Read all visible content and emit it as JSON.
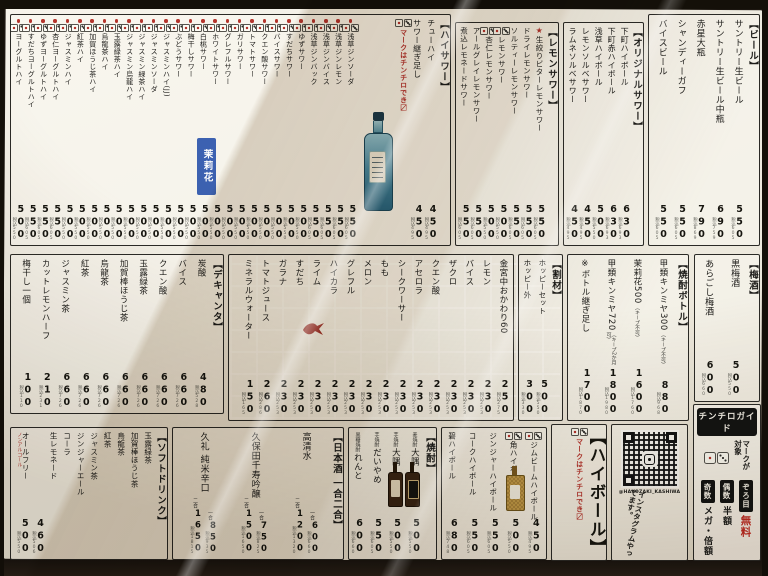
{
  "notes": {
    "chinchiro_hint": "マークはチンチロでき〼"
  },
  "sections": {
    "beer": {
      "title": "【ビール】",
      "items": [
        {
          "name": "サントリー生ビール",
          "price": "550",
          "tax": "税込605"
        },
        {
          "name": "サントリー生ビール中瓶",
          "price": "690",
          "tax": "税込759"
        },
        {
          "name": "赤星大瓶",
          "price": "790",
          "tax": "税込869"
        },
        {
          "name": "シャンディーガフ",
          "price": "550",
          "tax": "税込605"
        },
        {
          "name": "バイスビール",
          "price": "550",
          "tax": "税込605"
        }
      ]
    },
    "original_sour": {
      "title": "【オリジナルサワー】",
      "items": [
        {
          "name": "下町ハイボール",
          "price": "630",
          "tax": "税込693"
        },
        {
          "name": "下町赤ハイボール",
          "price": "630",
          "tax": "税込693"
        },
        {
          "name": "浅草ハイボール",
          "price": "500",
          "tax": "税込550"
        },
        {
          "name": "レモンソルベサワー",
          "price": "450",
          "tax": "税込495"
        },
        {
          "name": "ラムネソルベサワー",
          "price": "450",
          "tax": "税込495"
        }
      ]
    },
    "lemon_sour": {
      "title": "【レモンサワー】",
      "items": [
        {
          "name": "生絞りビターレモンサワー",
          "star": true,
          "price": "550",
          "tax": "税込605"
        },
        {
          "name": "ドライレモンサワー",
          "price": "550",
          "tax": "税込605"
        },
        {
          "name": "ソルティーレモンサワー",
          "price": "550",
          "tax": "税込605"
        },
        {
          "name": "レモンサワー",
          "dice": true,
          "price": "500",
          "tax": "税込550"
        },
        {
          "name": "杏仁レモンサワー",
          "dice": true,
          "price": "500",
          "tax": "税込550"
        },
        {
          "name": "アールグレイレモンサワー",
          "price": "550",
          "tax": "税込605"
        },
        {
          "name": "煮込レモネードサワー",
          "price": "550",
          "tax": "税込605"
        }
      ]
    },
    "haisawa": {
      "title": "【ハイサワー】",
      "lead_items": [
        {
          "name": "チューハイ",
          "price": "450",
          "tax": "税込495"
        },
        {
          "name": "サワー継ぎ足し",
          "price": "450",
          "tax": "税込495"
        }
      ],
      "note": "マークはチンチロでき〼",
      "items": [
        {
          "name": "浅草ジンソーダ",
          "dice": "red",
          "price": "550",
          "tax": "税込605"
        },
        {
          "name": "浅草ジンレモン",
          "dice": "red",
          "price": "550",
          "tax": "税込605"
        },
        {
          "name": "浅草ジンバイス",
          "dice": "red",
          "price": "550",
          "tax": "税込605"
        },
        {
          "name": "浅草ジンバック",
          "dice": "red",
          "price": "550",
          "tax": "税込605"
        },
        {
          "name": "ゆずサワー",
          "dice": "red",
          "price": "500",
          "tax": "税込550"
        },
        {
          "name": "すだちサワー",
          "dice": "red",
          "price": "500",
          "tax": "税込550"
        },
        {
          "name": "バイスサワー",
          "dice": "red",
          "price": "500",
          "tax": "税込550"
        },
        {
          "name": "クエン酸サワー",
          "dice": "red",
          "price": "500",
          "tax": "税込550"
        },
        {
          "name": "トマトサワー",
          "dice": "red",
          "price": "500",
          "tax": "税込550"
        },
        {
          "name": "ガリサワー",
          "dice": "red",
          "price": "500",
          "tax": "税込550"
        },
        {
          "name": "グレフルサワー",
          "dice": "red",
          "price": "500",
          "tax": "税込550"
        },
        {
          "name": "ホワイトサワー",
          "dice": "red",
          "price": "500",
          "tax": "税込550"
        },
        {
          "name": "白桃サワー",
          "dice": "red",
          "price": "500",
          "tax": "税込550"
        },
        {
          "name": "梅干しサワー",
          "dice": "red",
          "price": "500",
          "tax": "税込550"
        },
        {
          "name": "ぶどうサワー",
          "dice": "red",
          "price": "500",
          "tax": "税込550"
        },
        {
          "name": "ジャスミンハイ(JJ)",
          "dice": "red",
          "price": "500",
          "tax": "税込550"
        },
        {
          "name": "ジャスミンソーダ",
          "dice": "red",
          "price": "500",
          "tax": "税込550"
        },
        {
          "name": "ジャスミン緑茶ハイ",
          "dice": "red",
          "price": "500",
          "tax": "税込550"
        },
        {
          "name": "ジャスミン烏龍ハイ",
          "dice": "red",
          "price": "500",
          "tax": "税込550"
        },
        {
          "name": "玉露緑茶ハイ",
          "dice": "red",
          "price": "500",
          "tax": "税込550"
        },
        {
          "name": "烏龍茶ハイ",
          "dice": "red",
          "price": "500",
          "tax": "税込550"
        },
        {
          "name": "加賀ほうじ茶ハイ",
          "dice": "red",
          "price": "500",
          "tax": "税込550"
        },
        {
          "name": "紅茶ハイ",
          "dice": "red",
          "price": "500",
          "tax": "税込550"
        },
        {
          "name": "ジャスミンハイ",
          "dice": "red",
          "price": "500",
          "tax": "税込550"
        },
        {
          "name": "杏仁ヨーグルトハイ",
          "dice": "red",
          "price": "550",
          "tax": "税込605"
        },
        {
          "name": "ゆずヨーグルトハイ",
          "dice": "red",
          "price": "550",
          "tax": "税込605"
        },
        {
          "name": "すだちヨーグルトハイ",
          "dice": "red",
          "price": "550",
          "tax": "税込605"
        },
        {
          "name": "ヨーグルトハイ",
          "dice": "red",
          "price": "500",
          "tax": "税込550"
        }
      ]
    },
    "decanter": {
      "title": "【デキャンタ】",
      "items": [
        {
          "name": "炭酸",
          "price": "480",
          "tax": "税込528"
        },
        {
          "name": "バイス",
          "price": "660",
          "tax": "税込726"
        },
        {
          "name": "クエン酸",
          "price": "660",
          "tax": "税込726"
        },
        {
          "name": "玉露緑茶",
          "price": "660",
          "tax": "税込726"
        },
        {
          "name": "加賀棒ほうじ茶",
          "price": "660",
          "tax": "税込726"
        },
        {
          "name": "烏龍茶",
          "price": "660",
          "tax": "税込726"
        },
        {
          "name": "紅茶",
          "price": "660",
          "tax": "税込726"
        },
        {
          "name": "ジャスミン茶",
          "price": "660",
          "tax": "税込726"
        },
        {
          "name": "カットレモンハーフ",
          "price": "210",
          "tax": "税込231"
        },
        {
          "name": "梅干し一個",
          "price": "100",
          "tax": "税込110"
        }
      ]
    },
    "mixers": {
      "items": [
        {
          "name": "金宮中おかわり60",
          "price": "250",
          "tax": "税込275"
        },
        {
          "name": "レモン",
          "price": "230",
          "tax": "税込253"
        },
        {
          "name": "バイス",
          "price": "230",
          "tax": "税込253"
        },
        {
          "name": "ザクロ",
          "price": "230",
          "tax": "税込253"
        },
        {
          "name": "クエン酸",
          "price": "230",
          "tax": "税込253"
        },
        {
          "name": "アセロラ",
          "price": "230",
          "tax": "税込253"
        },
        {
          "name": "シークワーサー",
          "price": "230",
          "tax": "税込253"
        },
        {
          "name": "もも",
          "price": "230",
          "tax": "税込253"
        },
        {
          "name": "メロン",
          "price": "230",
          "tax": "税込253"
        },
        {
          "name": "グレフル",
          "price": "230",
          "tax": "税込253"
        },
        {
          "name": "ハイカラ",
          "price": "230",
          "tax": "税込253"
        },
        {
          "name": "ライム",
          "price": "230",
          "tax": "税込253"
        },
        {
          "name": "すだち",
          "price": "230",
          "tax": "税込253"
        },
        {
          "name": "ガラナ",
          "price": "230",
          "tax": "税込253"
        },
        {
          "name": "トマトジュース",
          "price": "260",
          "tax": "税込286"
        },
        {
          "name": "ミネラルウォーター",
          "price": "150",
          "tax": "税込165"
        }
      ]
    },
    "warizai": {
      "title": "【割材】",
      "items": [
        {
          "name": "ホッピーセット",
          "price": "500",
          "tax": "税込550"
        },
        {
          "name": "ホッピー外",
          "price": "300",
          "tax": "税込330"
        }
      ]
    },
    "shochu_bottle": {
      "title": "【焼酎ボトル】",
      "items": [
        {
          "name": "甲類キンミヤ300",
          "note": "（キープ不可）",
          "price": "880",
          "tax": "税込968"
        },
        {
          "name": "茉莉花500",
          "note": "（キープ不可）",
          "price": "1600",
          "tax": "税込1760"
        },
        {
          "name": "甲類キンミヤ720",
          "note": "（キープ2か月可）",
          "price": "1800",
          "tax": "税込1980"
        },
        {
          "name": "※ボトル継ぎ足し",
          "price": "1700",
          "tax": "税込1870"
        }
      ]
    },
    "umeshu": {
      "title": "【梅酒】",
      "items": [
        {
          "name": "黒梅酒",
          "price": "500",
          "tax": "税込550"
        },
        {
          "name": "あらごし梅酒",
          "price": "600",
          "tax": "税込660"
        }
      ]
    },
    "softdrink": {
      "title": "【ソフトドリンク】",
      "group_items": [
        "玉露緑茶",
        "加賀棒ほうじ茶",
        "烏龍茶",
        "紅茶",
        "ジャスミン茶",
        "ジンジャーエール",
        "コーラ",
        "生レモネード"
      ],
      "group_price": {
        "price": "460",
        "tax": "税込506"
      },
      "extra": {
        "name": "オールフリー",
        "red_note": "ノンアルコール",
        "price": "500",
        "tax": "税込550"
      }
    },
    "sake": {
      "title": "【日本酒 一合二合】",
      "items": [
        {
          "name": "高清水",
          "prices": [
            {
              "label": "一合",
              "price": "600",
              "tax": "税込660"
            },
            {
              "label": "二合",
              "price": "1200",
              "tax": "税込1320"
            }
          ]
        },
        {
          "name": "久保田千寿吟醸",
          "prices": [
            {
              "label": "一合",
              "price": "750",
              "tax": "税込825"
            },
            {
              "label": "二合",
              "price": "1500",
              "tax": "税込1650"
            }
          ]
        },
        {
          "name": "久礼 純米辛口",
          "prices": [
            {
              "label": "一合",
              "price": "850",
              "tax": "税込935"
            },
            {
              "label": "二合",
              "price": "1650",
              "tax": "税込1815"
            }
          ]
        }
      ]
    },
    "shochu": {
      "title": "【焼酎】",
      "items": [
        {
          "prefix": "麦焼酎",
          "name": "大隅",
          "price": "500",
          "tax": "税込550"
        },
        {
          "prefix": "芋焼酎",
          "name": "大隅",
          "price": "500",
          "tax": "税込550"
        },
        {
          "prefix": "芋焼酎",
          "name": "だいやめ",
          "price": "550",
          "tax": "税込605"
        },
        {
          "prefix": "黒糖焼酎",
          "name": "れんと",
          "price": "600",
          "tax": "税込660"
        }
      ]
    },
    "highball": {
      "title": "【ハイボール】",
      "note": "マークはチンチロでき〼",
      "items": [
        {
          "name": "ジムビームハイボール",
          "dice": true,
          "price": "450",
          "tax": "税込495"
        },
        {
          "name": "角ハイボール",
          "dice": true,
          "price": "500",
          "tax": "税込550"
        },
        {
          "name": "ジンジャーハイボール",
          "price": "550",
          "tax": "税込605"
        },
        {
          "name": "コークハイボール",
          "price": "550",
          "tax": "税込605"
        },
        {
          "name": "碧ハイボール",
          "price": "680",
          "tax": "税込748"
        }
      ]
    }
  },
  "instagram": {
    "handle": "@HAKOZAKI_KASHIWA",
    "caption": "インスタグラムやってます。"
  },
  "chinchiro_guide": {
    "title": "チンチロガイド",
    "target": "マークが対象",
    "rules": [
      {
        "roll": "ぞろ目",
        "result": "無料"
      },
      {
        "roll": "偶数",
        "result": "半額"
      },
      {
        "roll": "奇数",
        "result": "メガ・倍額"
      }
    ]
  },
  "stamp": {
    "text": "茉莉花"
  },
  "colors": {
    "accent_red": "#b5342c",
    "stamp_blue": "#2d55ac",
    "ink": "#1d1c19",
    "paper": "#f0ede3"
  }
}
